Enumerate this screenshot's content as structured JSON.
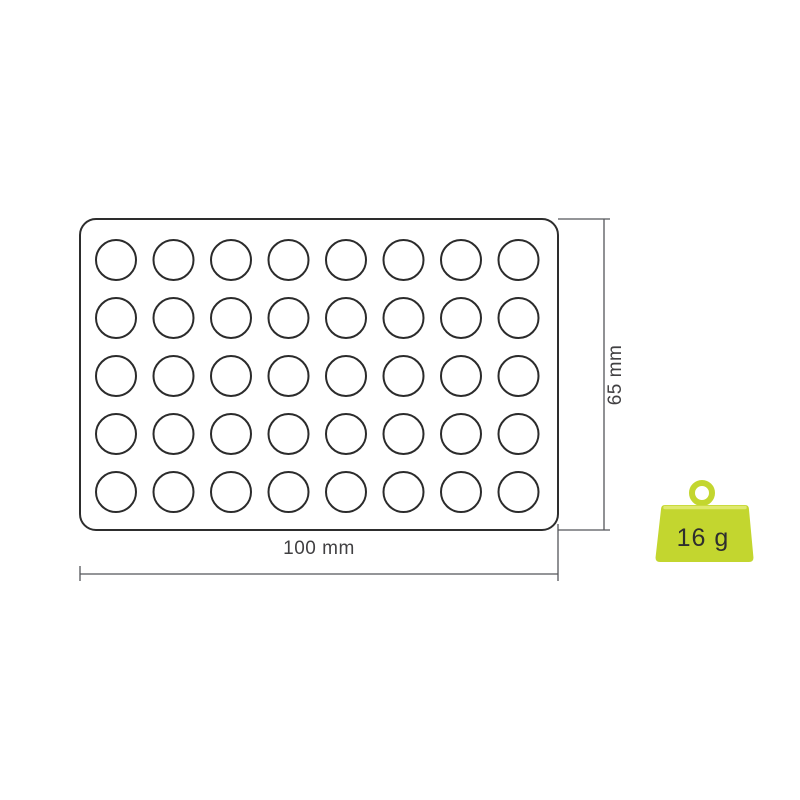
{
  "diagram": {
    "tray": {
      "rows": 5,
      "cols": 8,
      "cavity_count": 40
    },
    "dimensions": {
      "width_label": "100 mm",
      "height_label": "65 mm"
    }
  },
  "weight_badge": {
    "label": "16 g"
  },
  "colors": {
    "line_dark": "#2d2d2d",
    "dimension_gray": "#55565a",
    "text_gray": "#414042",
    "lime": "#c3d62f",
    "lime_light": "#dfe96e",
    "weight_text": "#2e2e2e"
  }
}
